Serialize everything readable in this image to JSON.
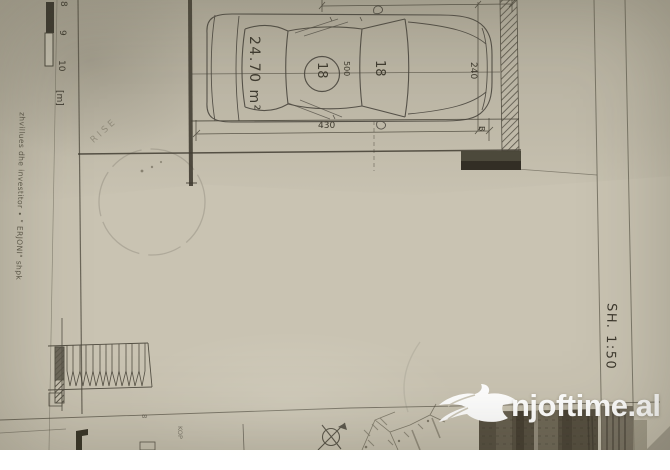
{
  "watermark": {
    "text": "njoftime.al",
    "icon": "bird"
  },
  "scale_bar": {
    "ticks": [
      "8",
      "9",
      "10"
    ],
    "unit": "[m]"
  },
  "plan": {
    "area_label": "24.70 m²",
    "circle_number": "18",
    "length_dim": "500",
    "spot_number": "18",
    "car_length_dim": "430",
    "width_dim": "240",
    "axis_label": "B"
  },
  "margin_notes": {
    "developer": "zhvillues dhe investitor ∙ \" ERJONI\" shpk",
    "scale": "SH. 1:50"
  },
  "faint_marks": {
    "stamp_fragment": "RISE",
    "bottom_word_fragment": "KOP",
    "line_mark": "8"
  },
  "colors": {
    "paper": "#c9c3b2",
    "ink": "#3f3b30",
    "watermark_white": "#ffffff",
    "photo_block": "#564f40"
  }
}
